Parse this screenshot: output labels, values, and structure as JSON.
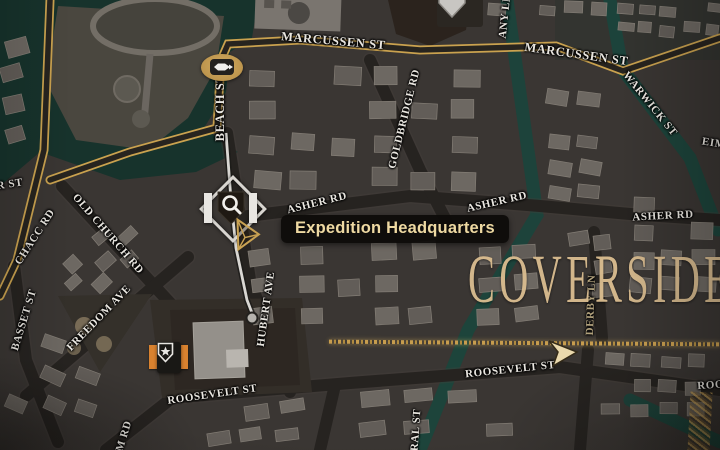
{
  "map": {
    "district_name": "COVERSIDE",
    "location_label": "Expedition Headquarters",
    "streets": {
      "marcussen_1": "MARCUSSEN ST",
      "marcussen_2": "MARCUSSEN ST",
      "beach": "BEACH ST",
      "any_ln": "ANY LN",
      "goldbridge": "GOLDBRIDGE RD",
      "warwick": "WARWICK ST",
      "eimc": "EIMC",
      "asher_1": "ASHER RD",
      "asher_2": "ASHER RD",
      "asher_3": "ASHER RD",
      "er_st": "ER ST",
      "chacc": "CHACC RD",
      "old_church": "OLD CHURCH RD",
      "basset": "BASSET ST",
      "freedom": "FREEDOM AVE",
      "hubert": "HUBERT AVE",
      "roosevelt_1": "ROOSEVELT ST",
      "roosevelt_2": "ROOSEVELT ST",
      "roosevelt_3": "ROOS",
      "m_rd": "M RD",
      "ral_st": "RAL ST",
      "derby": "DERBY LN"
    },
    "markers": {
      "quest": "expedition-headquarters-magnifier-marker",
      "ferry": "ferry-boat-marker",
      "police": "police-badge-marker",
      "landmark": "landmark-shield-marker",
      "cursor": "map-cursor-arrow",
      "route": "plotted-route-line",
      "border": "district-border-gold-dots"
    },
    "colors": {
      "gold_road": "#c9a14e",
      "flooded_street": "#1b453c",
      "dark_road": "#262320",
      "water": "#17332c",
      "building": "#6d6862",
      "label_text": "#e9e6e0",
      "district_text": "#d9bc8f",
      "tooltip_bg": "#0d0b08",
      "tooltip_text": "#eed9a2",
      "marker_orange": "#d9822f",
      "cursor_tan": "#ead9ad"
    }
  }
}
